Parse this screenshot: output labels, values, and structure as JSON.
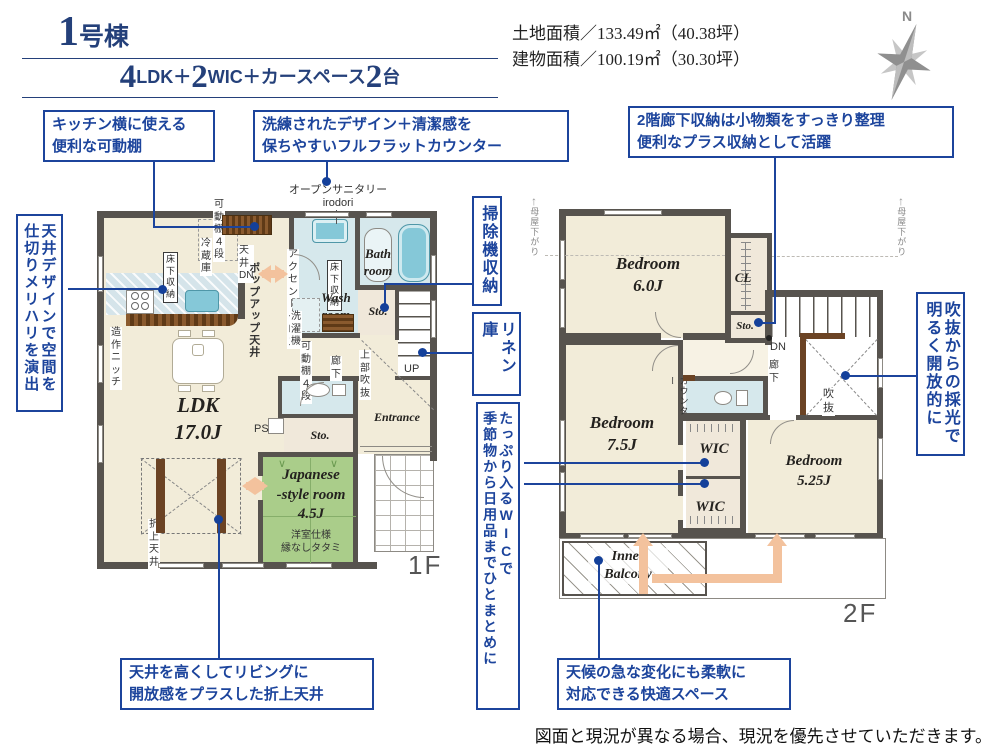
{
  "header": {
    "building_no": "1",
    "building_suffix": "号棟",
    "plan_n1": "4",
    "plan_t1": "LDK＋",
    "plan_n2": "2",
    "plan_t2": "WIC＋カースペース",
    "plan_n3": "2",
    "plan_t3": "台",
    "land_area": "土地面積／133.49㎡（40.38坪）",
    "building_area": "建物面積／100.19㎡（30.30坪）",
    "compass": "N"
  },
  "callouts": {
    "c1": "キッチン横に使える\n便利な可動棚",
    "c2": "洗練されたデザイン＋清潔感を\n保ちやすいフルフラットカウンター",
    "c3": "2階廊下収納は小物類をすっきり整理\n便利なプラス収納として活躍",
    "c4": "天井デザインで空間を\n仕切りメリハリを演出",
    "c5": "掃除機収納",
    "c6": "リネン庫",
    "c7": "たっぷり入るWICで\n季節物から日用品までひとまとめに",
    "c8": "吹抜からの採光で\n明るく開放的に",
    "c9": "天井を高くしてリビングに\n開放感をプラスした折上天井",
    "c10": "天候の急な変化にも柔軟に\n対応できる快適スペース"
  },
  "f1": {
    "floor_label": "1F",
    "open_sanitary": "オープンサニタリー",
    "irodori": "irodori",
    "shelf4_top": "可動棚４段",
    "fridge": "冷蔵庫",
    "ceiling_dn": "天井DN",
    "underfloor1": "床下\n収納",
    "popup_ceiling": "ポップアップ天井",
    "niche": "造作ニッチ",
    "ldk": "LDK\n17.0J",
    "folded_ceiling": "折上天井",
    "accent_cloth": "アクセントクロス",
    "underfloor2": "床下\n収納",
    "wash_room": "Wash\nroom",
    "washer": "洗濯機",
    "shelf4_mid": "可動棚４段",
    "hall": "廊下",
    "bath": "Bath\nroom",
    "sto1": "Sto.",
    "upper_void": "上部\n吹抜",
    "up": "UP",
    "ps": "PS",
    "sto2": "Sto.",
    "jp_room": "Japanese\n-style room\n4.5J",
    "jp_note": "洋室仕様\n縁なしタタミ",
    "entrance": "Entrance"
  },
  "f2": {
    "floor_label": "2F",
    "bed1": "Bedroom\n6.0J",
    "cl": "CL",
    "sto": "Sto.",
    "dn": "DN",
    "hall": "廊下",
    "void": "吹抜",
    "counter": "カウンター",
    "bed2": "Bedroom\n7.5J",
    "wic1": "WIC",
    "wic2": "WIC",
    "bed3": "Bedroom\n5.25J",
    "balcony": "Inner\nBalcony",
    "eaves_left": "母屋下がり",
    "eaves_right": "母屋下がり",
    "eaves_arrow": "↑"
  },
  "footer": {
    "disclaimer": "図面と現況が異なる場合、現況を優先させていただきます。"
  },
  "colors": {
    "wall": "#57534e",
    "room_cream": "#f2ecd9",
    "tatami_green": "#aacd8a",
    "wet_blue": "#d6e8ec",
    "fixture_teal": "#85c8d8",
    "callout_blue": "#1c449c",
    "header_navy": "#24407a",
    "arrow_orange": "#f3c29d"
  }
}
